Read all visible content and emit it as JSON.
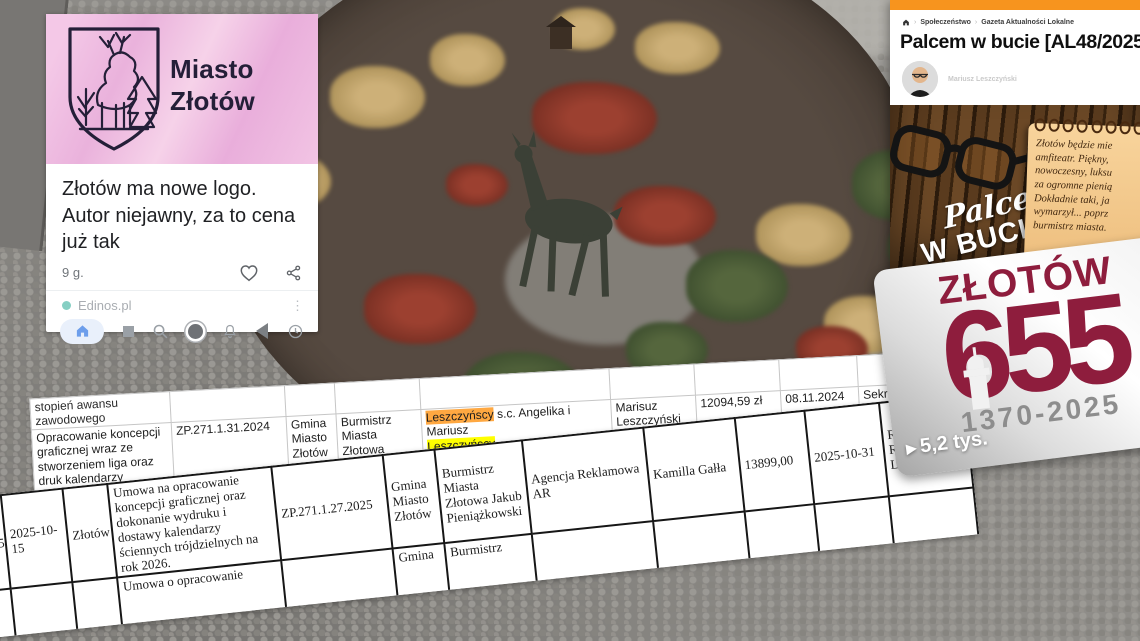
{
  "colors": {
    "accent_orange": "#F7941E",
    "maroon": "#8E1D3D",
    "highlight_orange": "#FFA841",
    "highlight_yellow": "#FFFF00",
    "card_pink": "#EFB9DF"
  },
  "discover_card": {
    "logo_line1": "Miasto",
    "logo_line2": "Złotów",
    "headline": "Złotów ma nowe logo. Autor niejawny, za to cena już tak",
    "timestamp": "9 g.",
    "source": "Edinos.pl",
    "menu_dots": "⋮"
  },
  "article": {
    "breadcrumb": {
      "item1": "Społeczeństwo",
      "item2": "Gazeta Aktualności Lokalne",
      "separator": "›"
    },
    "title": "Palcem w bucie [AL48/2025]",
    "author": "Mariusz Leszczyński",
    "image": {
      "script_word": "Palcem",
      "bold_words": "W BUCIE",
      "note_lines": {
        "l1": "Złotów będzie mie",
        "l2": "amfiteatr. Piękny,",
        "l3": "nowoczesny, luksu",
        "l4": "za ogromne pienią",
        "l5": "Dokładnie taki, ja",
        "l6": "wymarzył... poprz",
        "l7": "burmistrz miasta."
      }
    }
  },
  "anniversary_card": {
    "city": "ZŁOTÓW",
    "number": "655",
    "years": "1370-2025",
    "views_arrow": "▶",
    "views": "5,2 tys."
  },
  "table_top": {
    "header_partial": "stopień awansu zawodowego",
    "row": {
      "c1": "Opracowanie koncepcji graficznej wraz ze stworzeniem liga oraz druk kalendarzy trójdzielnych na rok 2025",
      "c2": "ZP.271.1.31.2024",
      "c3": "Gmina Miasto Złotów",
      "c4": "Burmistrz Miasta Złotowa Jakub Pieniążkowski",
      "c5_hl1": "Leszczyńscy",
      "c5_mid": " s.c. Angelika i Mariusz",
      "c5_hl2": "Leszczyńscy",
      "c6": "Marisuz Leszczyński",
      "c7": "12094,59 zł",
      "c8": "08.11.2024",
      "c9": "Sekretarz"
    }
  },
  "table_bottom": {
    "row1": {
      "c1": "330.2025",
      "c2": "2025-10-15",
      "c3": "Złotów",
      "c4": "Umowa na opracowanie koncepcji graficznej oraz dokonanie wydruku i dostawy kalendarzy ściennych trójdzielnych na rok 2026.",
      "c5": "ZP.271.1.27.2025",
      "c6": "Gmina Miasto Złotów",
      "c7": "Burmistrz Miasta Złotowa Jakub Pieniążkowski",
      "c8": "Agencja Reklamowa AR",
      "c9": "Kamilla Gałła",
      "c10": "13899,00",
      "c11": "2025-10-31",
      "c12": "Referat Rozwoju Lokalnego"
    },
    "row2": {
      "c4": "Umowa o opracowanie",
      "c6": "Gmina",
      "c7": "Burmistrz"
    }
  }
}
